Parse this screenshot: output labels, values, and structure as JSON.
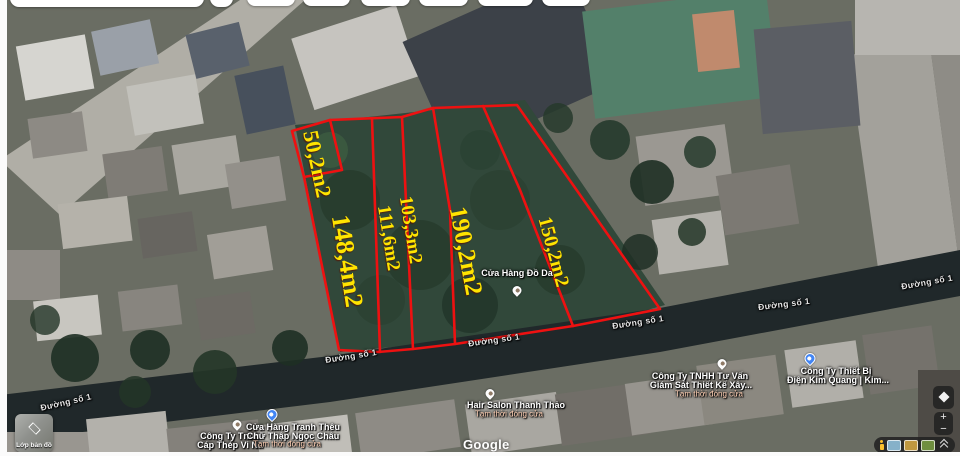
{
  "map": {
    "parcels": [
      {
        "area": "50,2m2"
      },
      {
        "area": "148,4m2"
      },
      {
        "area": "111,6m2"
      },
      {
        "area": "103,3m2"
      },
      {
        "area": "190,2m2"
      },
      {
        "area": "150,2m2"
      }
    ],
    "street_label": "Đường số 1",
    "pois": [
      {
        "line1": "Cửa Hàng Đồ Da",
        "line2": "",
        "status": "",
        "pin": "white"
      },
      {
        "line1": "Hair Salon Thanh Thảo",
        "line2": "",
        "status": "Tạm thời đóng cửa",
        "pin": "white"
      },
      {
        "line1": "Công Ty Tnhh",
        "line2": "Cáp Thép Vi Na",
        "status": "",
        "pin": "white"
      },
      {
        "line1": "Cửa Hàng Tranh Thêu",
        "line2": "Chữ Thập Ngọc Châu",
        "status": "Tạm thời đóng cửa",
        "pin": "blue"
      },
      {
        "line1": "Công Ty TNHH Tư Vấn",
        "line2": "Giám Sát Thiết Kế Xây...",
        "status": "Tạm thời đóng cửa",
        "pin": "white"
      },
      {
        "line1": "Công Ty Thiết Bị",
        "line2": "Điện Kim Quang | Kim...",
        "status": "",
        "pin": "blue"
      }
    ],
    "watermark": "Google"
  },
  "controls": {
    "layers_label": "Lớp bản đồ",
    "zoom_in": "+",
    "zoom_out": "−"
  },
  "icons": {
    "layers": "layers-icon",
    "compass": "compass-icon",
    "zoom_in": "plus-icon",
    "zoom_out": "minus-icon",
    "pegman": "pegman-icon",
    "collapse": "chevron-up-icon",
    "poi_pin": "map-pin-icon"
  },
  "colors": {
    "parcel_line": "#ee1111",
    "parcel_label": "#ffe400",
    "pin_blue": "#4285f4",
    "road_shadow": "#20282a",
    "vegetation": "#31483a"
  }
}
